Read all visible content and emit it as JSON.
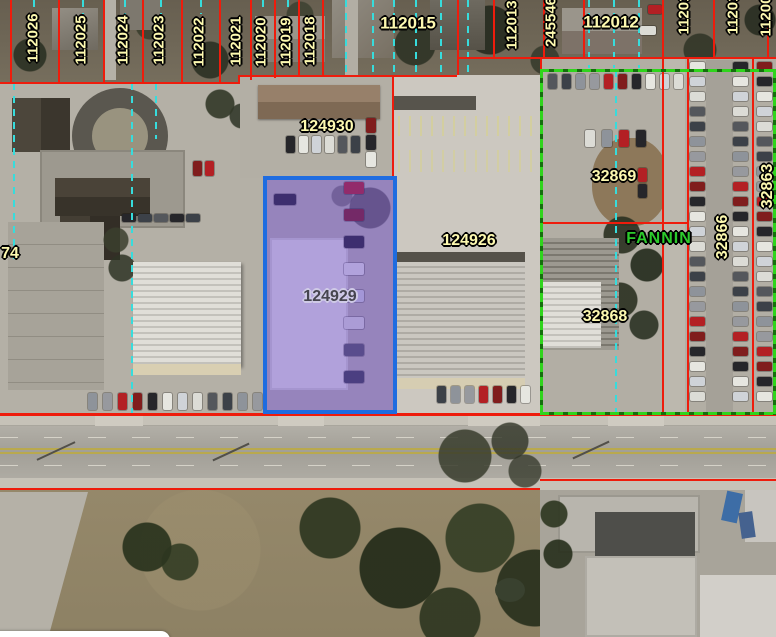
{
  "map": {
    "type": "aerial-parcel-map",
    "street_label": "FANNIN",
    "selected_parcel_id": "124929",
    "colors": {
      "parcel_line_red": "#ee1c0c",
      "subdivision_green": "#2fd41c",
      "centerline_cyan": "#37dcdc",
      "selection_border_blue": "#1f6ce0",
      "selection_fill_purple": "rgba(97,61,214,0.40)",
      "parcel_label_fill": "#fdf9b0",
      "selected_label_fill": "#46454f",
      "street_label_fill": "#2ccb2c"
    },
    "labels": [
      {
        "text": "112026",
        "x": 33,
        "y": 38,
        "rot": -90,
        "kind": "parcel",
        "size": 15
      },
      {
        "text": "112025",
        "x": 81,
        "y": 40,
        "rot": -90,
        "kind": "parcel",
        "size": 15
      },
      {
        "text": "112024",
        "x": 123,
        "y": 40,
        "rot": -90,
        "kind": "parcel",
        "size": 15
      },
      {
        "text": "112023",
        "x": 159,
        "y": 40,
        "rot": -90,
        "kind": "parcel",
        "size": 15
      },
      {
        "text": "112022",
        "x": 199,
        "y": 42,
        "rot": -90,
        "kind": "parcel",
        "size": 15
      },
      {
        "text": "112021",
        "x": 236,
        "y": 41,
        "rot": -90,
        "kind": "parcel",
        "size": 15
      },
      {
        "text": "112020",
        "x": 261,
        "y": 42,
        "rot": -90,
        "kind": "parcel",
        "size": 15
      },
      {
        "text": "112019",
        "x": 286,
        "y": 42,
        "rot": -90,
        "kind": "parcel",
        "size": 15
      },
      {
        "text": "112018",
        "x": 310,
        "y": 41,
        "rot": -90,
        "kind": "parcel",
        "size": 15
      },
      {
        "text": "112015",
        "x": 408,
        "y": 23,
        "rot": 0,
        "kind": "parcel",
        "size": 17
      },
      {
        "text": "112013",
        "x": 512,
        "y": 25,
        "rot": -90,
        "kind": "parcel",
        "size": 15
      },
      {
        "text": "245546",
        "x": 551,
        "y": 22,
        "rot": -90,
        "kind": "parcel",
        "size": 15
      },
      {
        "text": "112012",
        "x": 611,
        "y": 22,
        "rot": 0,
        "kind": "parcel",
        "size": 17
      },
      {
        "text": "11201",
        "x": 684,
        "y": 14,
        "rot": -90,
        "kind": "parcel",
        "size": 15
      },
      {
        "text": "11201",
        "x": 733,
        "y": 14,
        "rot": -90,
        "kind": "parcel",
        "size": 15
      },
      {
        "text": "11200",
        "x": 766,
        "y": 16,
        "rot": -90,
        "kind": "parcel",
        "size": 15
      },
      {
        "text": "124930",
        "x": 327,
        "y": 127,
        "rot": 0,
        "kind": "parcel",
        "size": 16
      },
      {
        "text": "124926",
        "x": 469,
        "y": 241,
        "rot": 0,
        "kind": "parcel",
        "size": 16
      },
      {
        "text": "124929",
        "x": 330,
        "y": 297,
        "rot": 0,
        "kind": "selected",
        "size": 16
      },
      {
        "text": "32869",
        "x": 614,
        "y": 177,
        "rot": 0,
        "kind": "parcel",
        "size": 16
      },
      {
        "text": "32868",
        "x": 605,
        "y": 317,
        "rot": 0,
        "kind": "parcel",
        "size": 16
      },
      {
        "text": "32866",
        "x": 723,
        "y": 237,
        "rot": -90,
        "kind": "parcel",
        "size": 16
      },
      {
        "text": "32863",
        "x": 768,
        "y": 186,
        "rot": -90,
        "kind": "parcel",
        "size": 16
      },
      {
        "text": "74",
        "x": 10,
        "y": 254,
        "rot": 0,
        "kind": "parcel",
        "size": 16
      },
      {
        "text": "FANNIN",
        "x": 659,
        "y": 239,
        "rot": 0,
        "kind": "street",
        "size": 16
      }
    ]
  }
}
